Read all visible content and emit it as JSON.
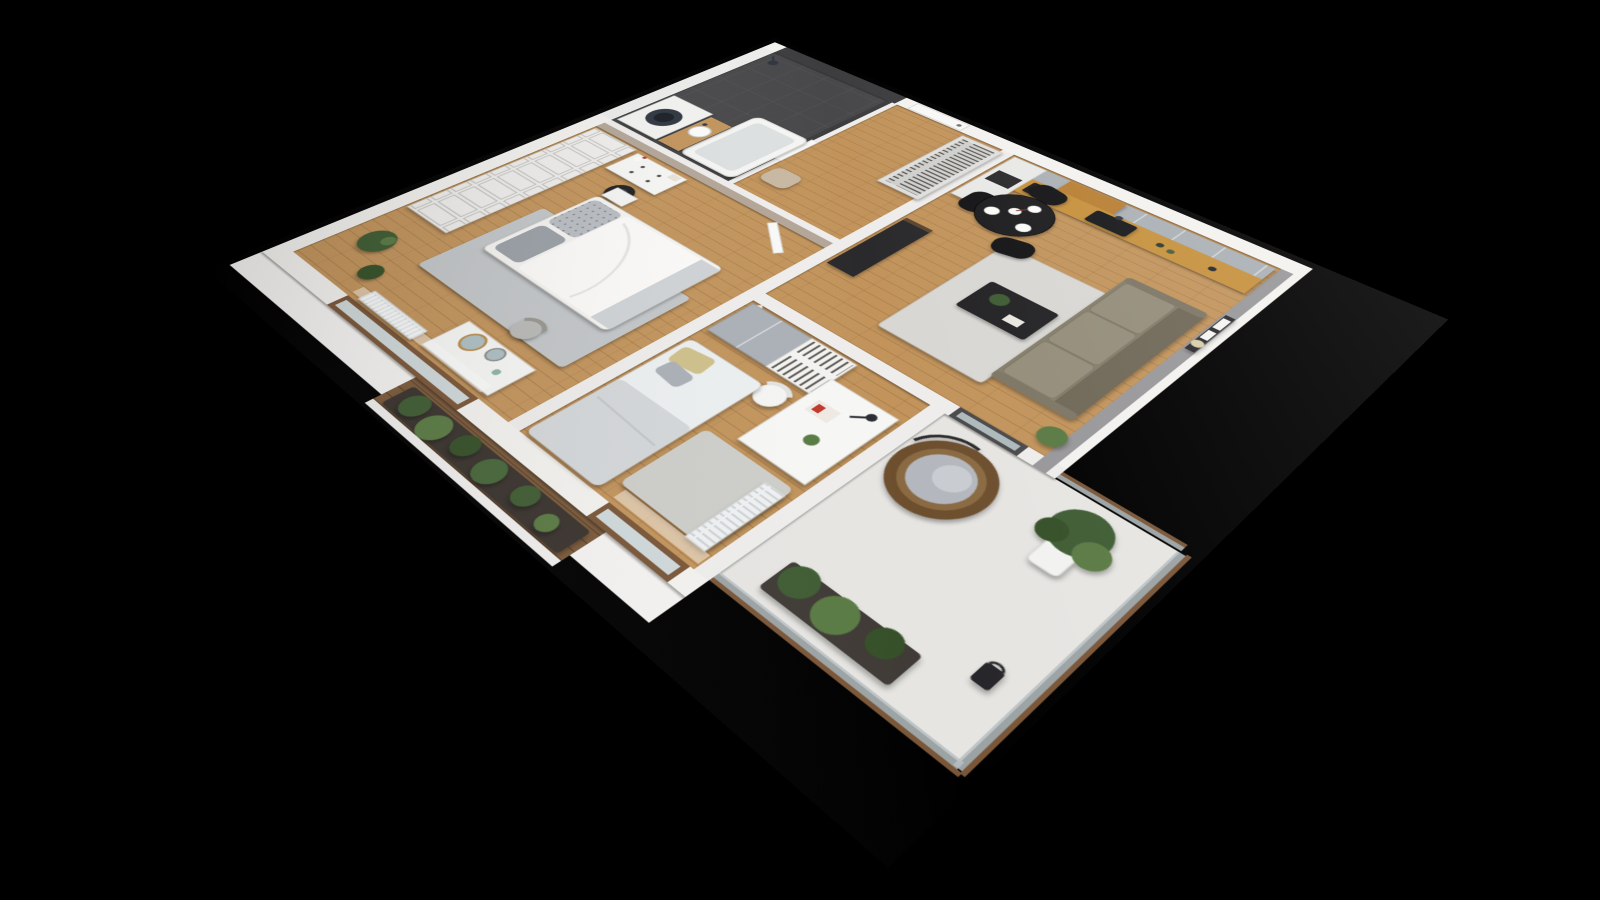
{
  "scene": {
    "description": "3D cutaway floor-plan render of a furnished two-bedroom apartment viewed from above at an angle, on a plain black background",
    "view": "top-down perspective (dollhouse cutaway, walls cut at height)",
    "background_color": "#000000",
    "text_visible": "none"
  },
  "palette": {
    "bg": "#000000",
    "wall": "#f3f2ef",
    "wallEdge": "#d9d8d5",
    "wallGrey": "#98989b",
    "wallBeige": "#b3a698",
    "tileDark": "#3d3d3f",
    "bathFloor": "#48484a",
    "wood": "#c2945c",
    "woodDeck": "#7b5a3b",
    "balconyFloor": "#e6e5e2",
    "rug": "#d8d7d3",
    "rugBlue": "#c3c6c8",
    "sofa": "#857e6c",
    "sofaSeat": "#948d7a",
    "sofaBack": "#6f6857",
    "black": "#1d1d1f",
    "cabinetGrey": "#aab0b5",
    "counterWood": "#c6913d",
    "shelfWood": "#b97f33",
    "white": "#f8f8f6",
    "plant": "#3f5c33",
    "plantLight": "#5a7a44",
    "plantDeep": "#355028",
    "rattan": "#6d4f2e",
    "rattanLight": "#8a6a42",
    "cushion": "#b4b7bd",
    "glass": "#b7bfc2",
    "frame": "#7a5638",
    "radiator": "#eef0f1",
    "steel": "#2f3640",
    "tan": "#c8b8a2"
  },
  "rooms": [
    {
      "name": "Entrance hall",
      "floor": "wood",
      "furniture": [
        "entrance door (closed, white)",
        "coat wardrobe with clothes on hangers",
        "pouf"
      ]
    },
    {
      "name": "Bathroom",
      "floor": "dark grey tile",
      "furniture": [
        "bathtub",
        "washing machine with round door",
        "washbasin on wood counter",
        "shower head",
        "dark anthracite wall tiles",
        "white tile wall"
      ]
    },
    {
      "name": "Kitchen",
      "floor": "wood",
      "furniture": [
        "tall oven cabinet",
        "grey upper cabinets",
        "open wood shelves",
        "wood worktop",
        "black sink with faucet",
        "coffee machine"
      ]
    },
    {
      "name": "Living room",
      "floor": "wood",
      "furniture": [
        "round black dining table with plates and flower vase",
        "three black dining chairs",
        "olive three-seat sofa",
        "picture ledge with two frames and round mirror",
        "black coffee table with plant",
        "dark TV sideboard",
        "grey rug",
        "glazed balcony door",
        "grey accent wall"
      ]
    },
    {
      "name": "Second bedroom / study",
      "floor": "wood",
      "furniture": [
        "wardrobe with open clothes rail",
        "white desk",
        "desk lamp",
        "magazine",
        "white chair",
        "day bed with mustard and grey pillows",
        "radiator",
        "window with wood frame",
        "sheer curtain"
      ]
    },
    {
      "name": "Master bedroom",
      "floor": "wood",
      "furniture": [
        "built-in paneled wardrobe wall",
        "white dresser with black basket and vase",
        "double bed with white duvet and patterned grey pillows",
        "nightstand",
        "grey-blue rug",
        "vanity table with two round mirrors",
        "chair",
        "two potted plants",
        "radiator",
        "window with wood frame",
        "sheer curtain",
        "beige accent wall"
      ]
    },
    {
      "name": "Main balcony",
      "floor": "light concrete",
      "furniture": [
        "hanging rattan egg chair with grey cushion",
        "potted tree",
        "planter with green plants",
        "black lantern",
        "glass railing with wood handrail"
      ]
    },
    {
      "name": "Bedroom balcony",
      "floor": "wood deck",
      "furniture": [
        "dark planter full of plants",
        "railing"
      ]
    }
  ]
}
